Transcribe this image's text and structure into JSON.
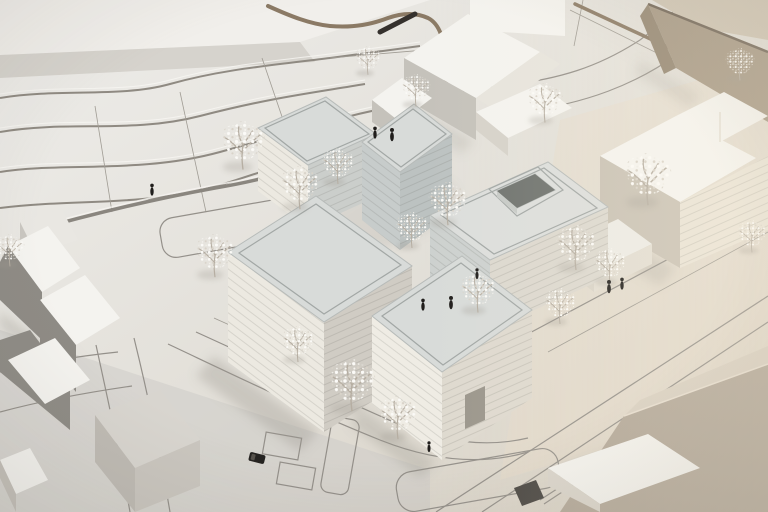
{
  "scene": {
    "type": "photograph",
    "subject": "Aerial photograph of a white architectural massing model: five new flat-roofed volumes (one with a square roof courtyard) around a plaza, surrounded by gabled context houses, wire-like white trees, black scale figures and streets drawn on the baseboard with topographic terracing in the upper left",
    "visible_text": ""
  },
  "palette": {
    "ground_light": "#ecebe7",
    "ground_mid": "#ded9d0",
    "ground_cool": "#cdccc8",
    "ground_warm": "#e6dcc9",
    "slab_top": "#f1efeb",
    "slab_side": "#d6d3cd",
    "contour": "#8f8a82",
    "pencil": "#a09c94",
    "road": "#94908a",
    "curb": "#8a867f",
    "wall_brown": "#8b7a65",
    "roof": "#d8dbd9",
    "roof_d": "#dcdedc",
    "roof_edge": "#b7bbb9",
    "roof_line": "#a2a7a5",
    "face_sw": "#ece9e1",
    "face_se": "#dcd8cf",
    "tower_sw": "#c7cccb",
    "tower_se": "#bcc2c1",
    "white_hi": "#f4f3ef",
    "gable": "#c5c2bb",
    "dark_gable": "#8e8b85",
    "tan_top": "#cfc5b4",
    "tan_face": "#a69884",
    "lblock_left": "#c9c2b5",
    "lblock_front": "#e9e3d6",
    "br_block": "#b2a798",
    "br_top": "#d8cfc1",
    "hole_dark": "#6f736f",
    "hole_light": "#c6cac7",
    "tree_branch": "#b6aea2",
    "figure": "#201e1c",
    "shadow": "#9d988f",
    "mark_dark": "#35312d"
  },
  "objects": {
    "proposal_buildings": [
      "north-tower",
      "center-tower",
      "courtyard-block",
      "west-slab",
      "south-block"
    ],
    "context_buildings": [
      "gabled-house-north",
      "small-house-north",
      "tan-house-northeast",
      "l-block-east",
      "low-box-east",
      "gabled-houses-southwest",
      "flat-block-south",
      "block-southeast"
    ],
    "tree_count": 20,
    "figure_count": 9,
    "vehicle_count": 1,
    "roof_courtyard_count": 1
  }
}
